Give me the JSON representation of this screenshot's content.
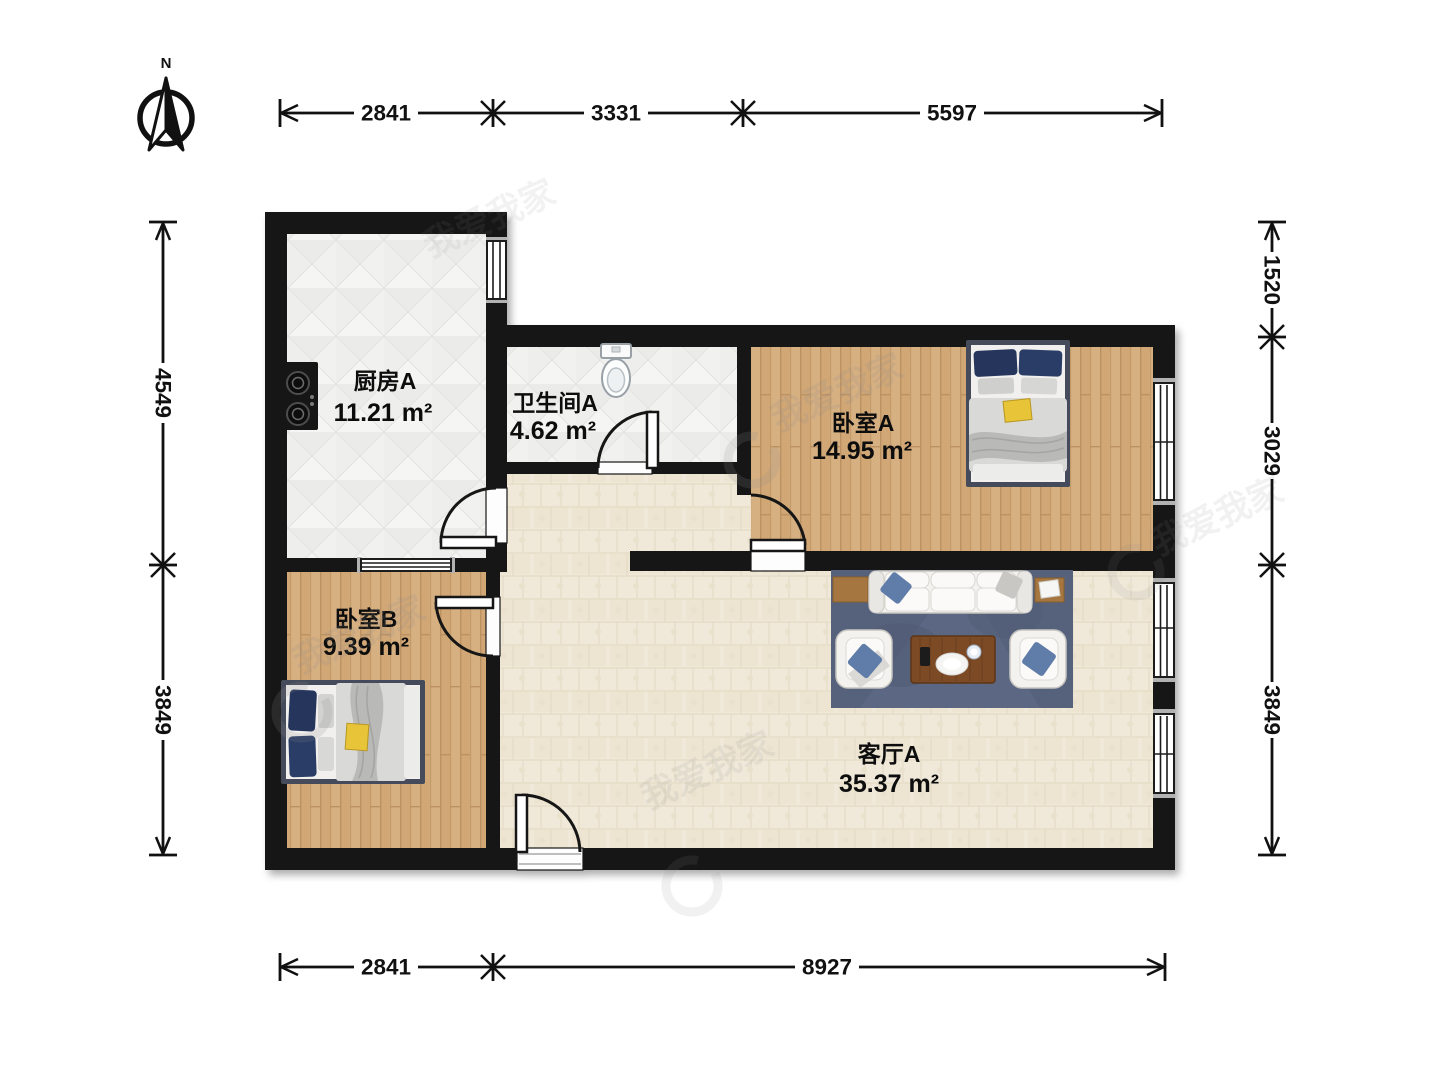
{
  "compass": {
    "north_label": "N"
  },
  "watermark": {
    "brand_text": "我爱我家"
  },
  "rooms": {
    "kitchen": {
      "name": "厨房A",
      "area": "11.21 m²"
    },
    "bathroom": {
      "name": "卫生间A",
      "area": "4.62 m²"
    },
    "bedroom_a": {
      "name": "卧室A",
      "area": "14.95 m²"
    },
    "bedroom_b": {
      "name": "卧室B",
      "area": "9.39 m²"
    },
    "living_room": {
      "name": "客厅A",
      "area": "35.37 m²"
    }
  },
  "dimensions_mm": {
    "top": [
      "2841",
      "3331",
      "5597"
    ],
    "bottom": [
      "2841",
      "8927"
    ],
    "left": [
      "4549",
      "3849"
    ],
    "right": [
      "1520",
      "3029",
      "3849"
    ]
  },
  "colors": {
    "wall": "#141414",
    "wood_floor": "#d3aa79",
    "tile_floor": "#f0f0ee",
    "living_floor": "#f0e9da",
    "rug": "#56627c",
    "pillow_navy": "#2c3d66",
    "pillow_blue": "#5f7da8",
    "duvet_gray": "#d9d9d7",
    "magazine_yellow": "#e7c437",
    "coffee_table": "#7c4b28"
  }
}
